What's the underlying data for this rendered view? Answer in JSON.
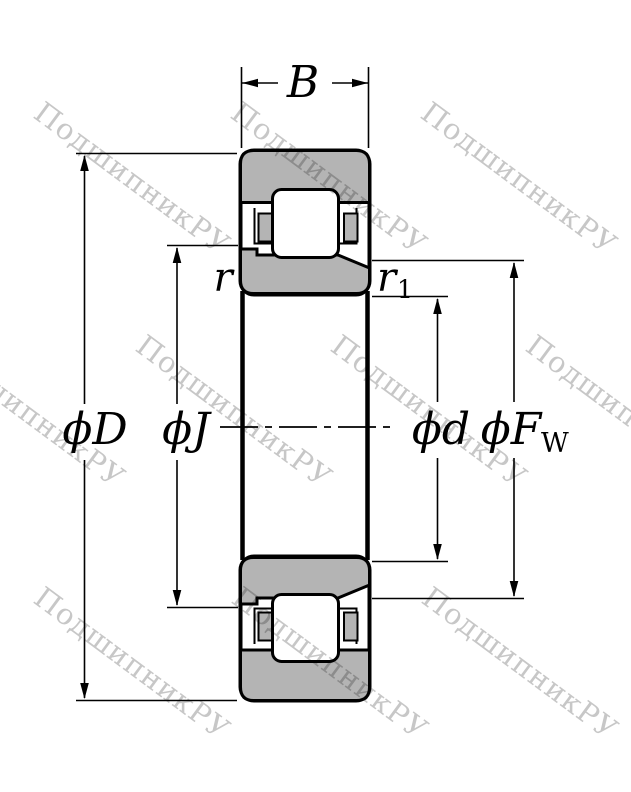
{
  "diagram": {
    "type": "cylindrical-roller-bearing-cross-section",
    "labels": {
      "width": "B",
      "outer_diameter": "ϕD",
      "rib_diameter": "ϕJ",
      "bore_diameter": "ϕd",
      "raceway_diameter_main": "ϕF",
      "raceway_diameter_sub": "W",
      "chamfer_outer": "r",
      "chamfer_inner_main": "r",
      "chamfer_inner_sub": "1"
    },
    "colors": {
      "line": "#000000",
      "ring_fill": "#b4b4b4",
      "roller_fill": "#ffffff",
      "watermark": "#c7c7c7"
    }
  },
  "watermark": {
    "text": "ПодшипникРУ"
  }
}
